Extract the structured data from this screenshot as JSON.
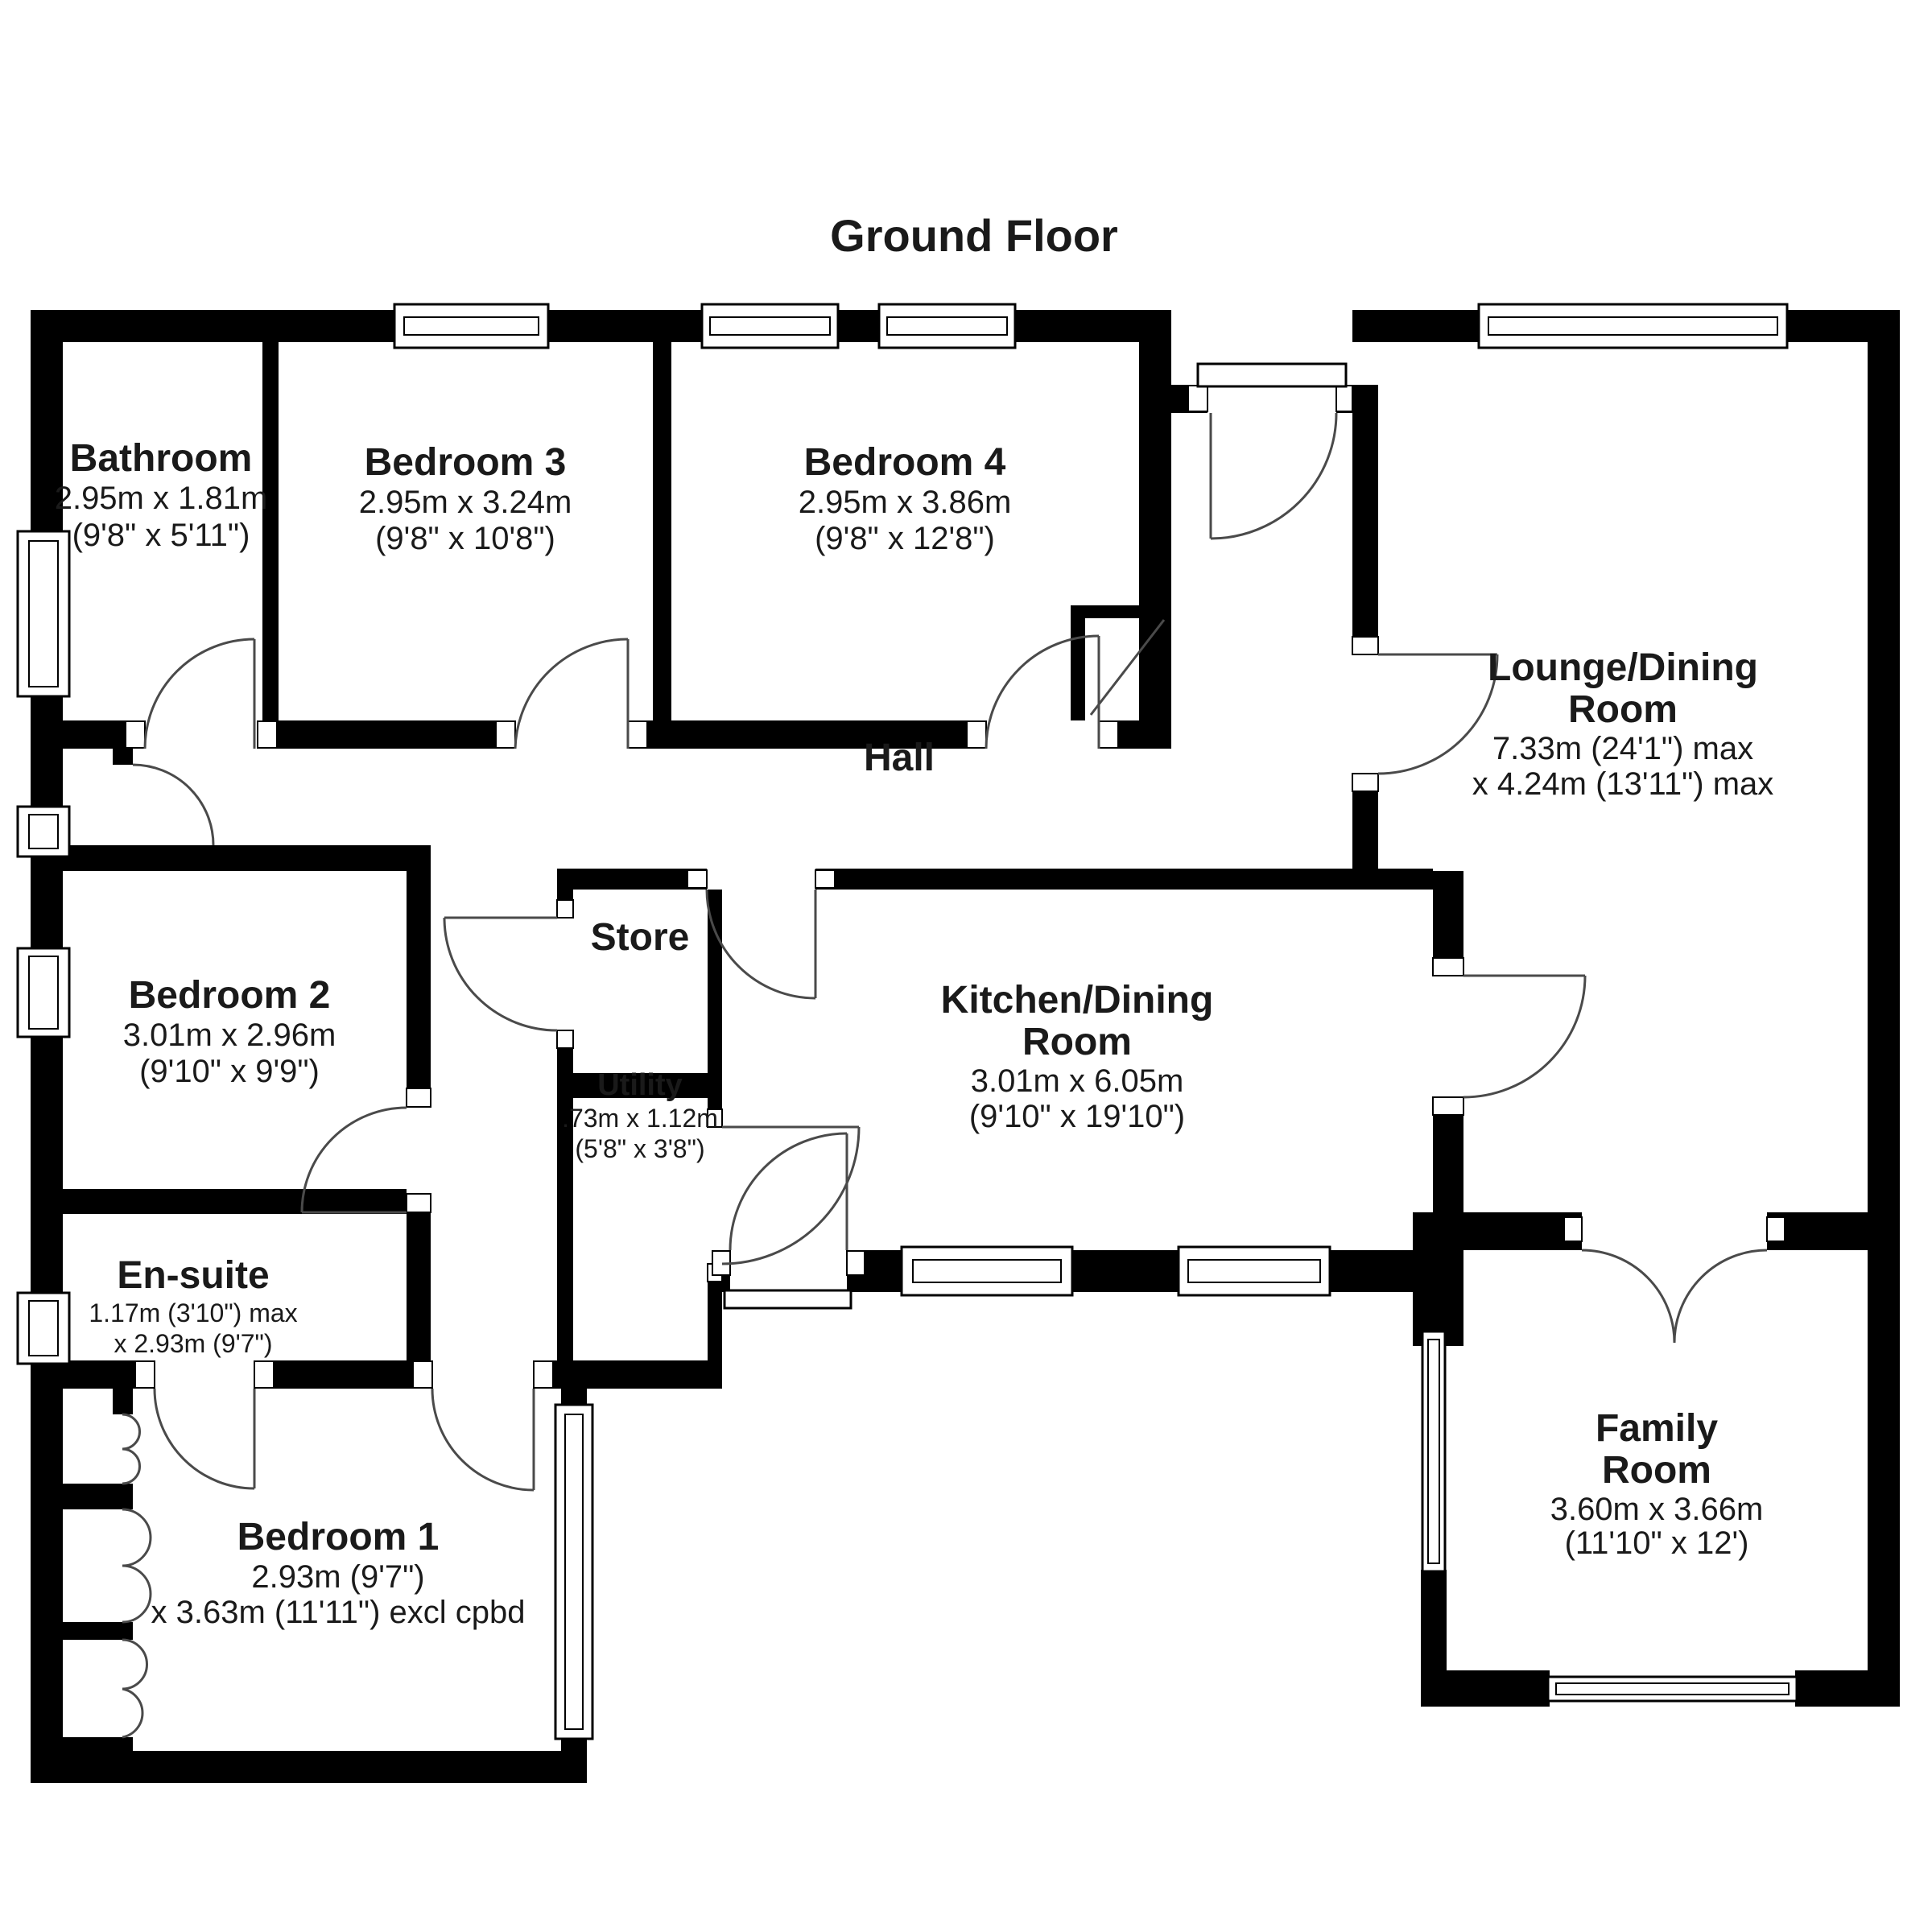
{
  "title": "Ground Floor",
  "colors": {
    "wall": "#000000",
    "door_line": "#4a4a4a",
    "background": "#ffffff"
  },
  "rooms": {
    "bathroom": {
      "name": "Bathroom",
      "dims": [
        "2.95m x 1.81m",
        "(9'8\" x 5'11\")"
      ]
    },
    "bedroom3": {
      "name": "Bedroom 3",
      "dims": [
        "2.95m x 3.24m",
        "(9'8\" x 10'8\")"
      ]
    },
    "bedroom4": {
      "name": "Bedroom 4",
      "dims": [
        "2.95m x 3.86m",
        "(9'8\" x 12'8\")"
      ]
    },
    "lounge": {
      "name": [
        "Lounge/Dining",
        "Room"
      ],
      "dims": [
        "7.33m (24'1\") max",
        "x 4.24m (13'11\") max"
      ]
    },
    "hall": {
      "name": "Hall"
    },
    "bedroom2": {
      "name": "Bedroom 2",
      "dims": [
        "3.01m x 2.96m",
        "(9'10\" x 9'9\")"
      ]
    },
    "store": {
      "name": "Store"
    },
    "utility": {
      "name": "Utility",
      "dims": [
        ".73m x 1.12m",
        "(5'8\" x 3'8\")"
      ]
    },
    "kitchen": {
      "name": [
        "Kitchen/Dining",
        "Room"
      ],
      "dims": [
        "3.01m x 6.05m",
        "(9'10\" x 19'10\")"
      ]
    },
    "ensuite": {
      "name": "En-suite",
      "dims": [
        "1.17m (3'10\") max",
        "x 2.93m (9'7\")"
      ]
    },
    "bedroom1": {
      "name": "Bedroom 1",
      "dims": [
        "2.93m (9'7\")",
        "x 3.63m (11'11\") excl cpbd"
      ]
    },
    "family": {
      "name": [
        "Family",
        "Room"
      ],
      "dims": [
        "3.60m x 3.66m",
        "(11'10\" x 12')"
      ]
    }
  }
}
